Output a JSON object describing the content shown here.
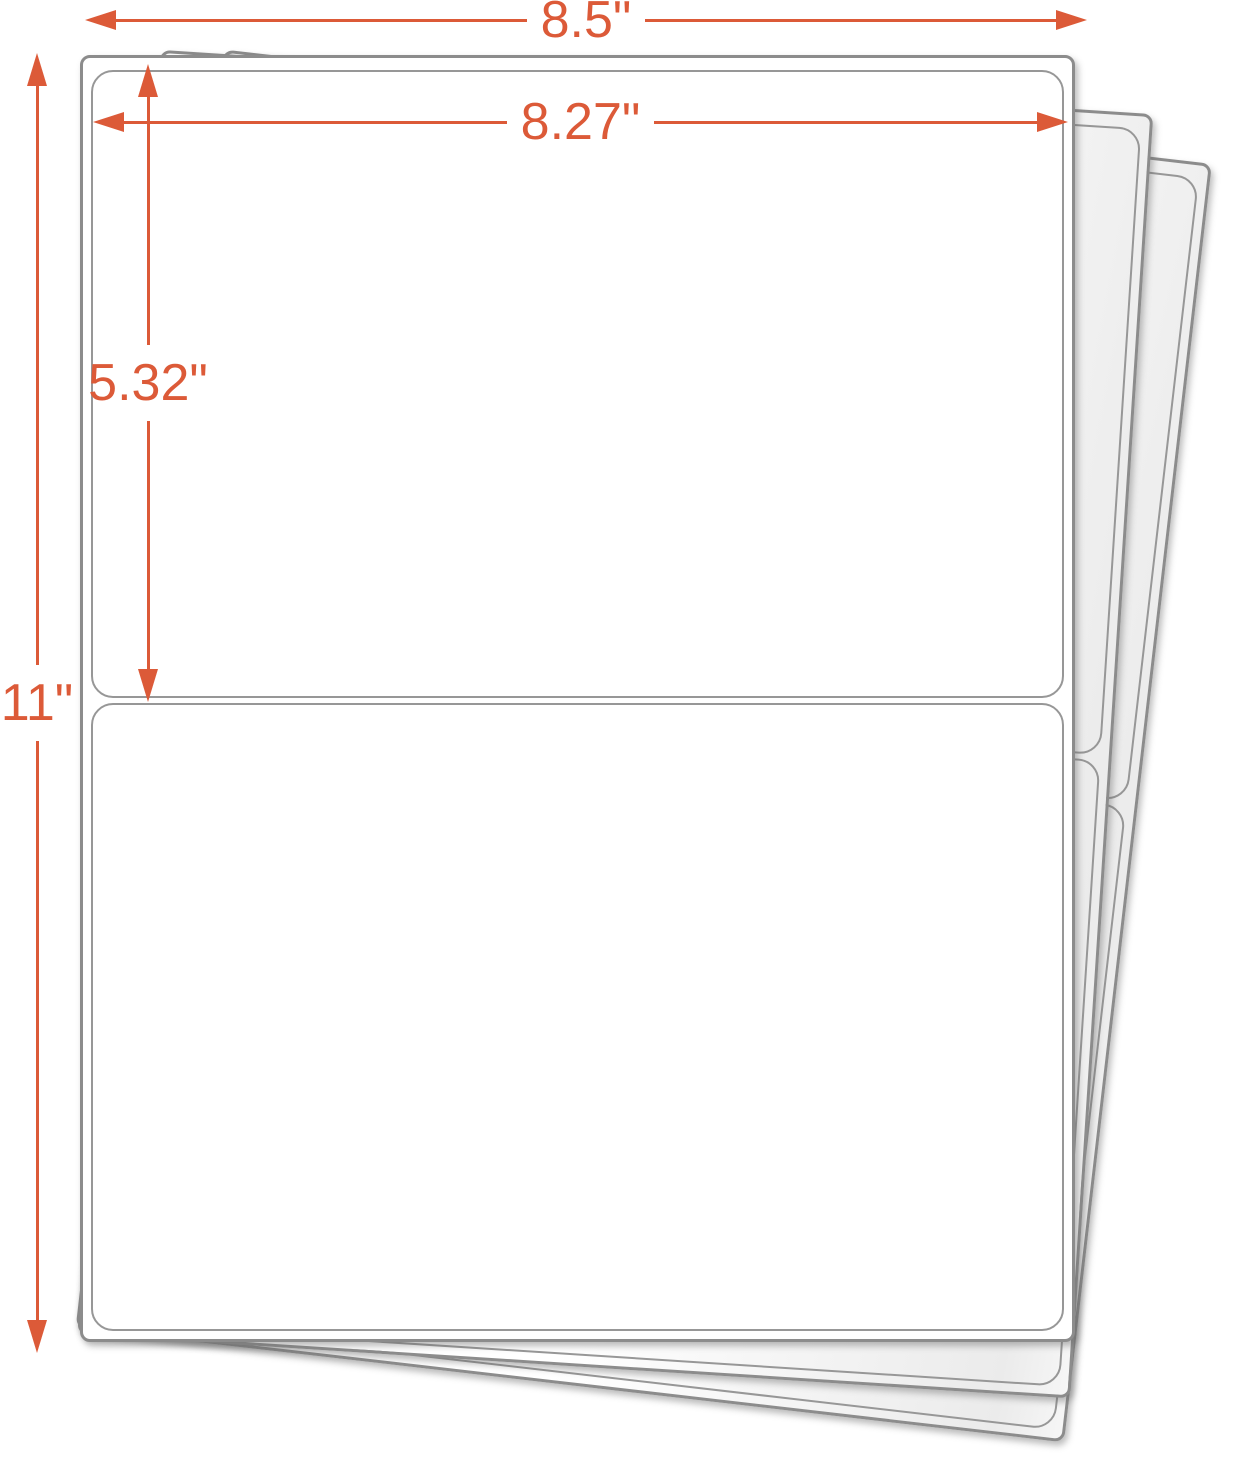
{
  "illustration": {
    "name": "half-sheet shipping label stack",
    "sheets_visible": 3,
    "labels_per_sheet": 2
  },
  "dimensions": {
    "sheet_width": {
      "label": "8.5\""
    },
    "label_width": {
      "label": "8.27\""
    },
    "label_height": {
      "label": "5.32\""
    },
    "sheet_height": {
      "label": "11\""
    }
  },
  "colors": {
    "dimension_accent": "#DC5A38",
    "sheet_border": "#8C8C8C",
    "label_border": "#979797"
  }
}
